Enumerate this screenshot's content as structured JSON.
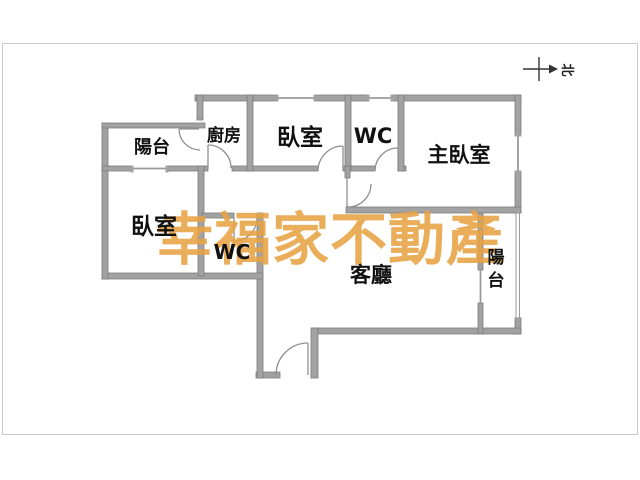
{
  "page": {
    "background": "#ffffff",
    "frame_border_color": "#cbcbcb"
  },
  "floor_plan": {
    "wall_fill": "#a2a2a2",
    "wall_edge": "#7d7d7d",
    "window_line": "#9a9a9a",
    "door_arc": "#8f8f8f",
    "rooms": {
      "balcony_left": {
        "label": "陽台"
      },
      "kitchen": {
        "label": "廚房"
      },
      "bedroom_top": {
        "label": "臥室"
      },
      "wc_top": {
        "label": "WC"
      },
      "master_bedroom": {
        "label": "主臥室"
      },
      "bedroom_left": {
        "label": "臥室"
      },
      "wc_bottom": {
        "label": "WC"
      },
      "living_room": {
        "label": "客廳"
      },
      "balcony_right": {
        "label": "陽台",
        "chars": [
          "陽",
          "台"
        ]
      }
    },
    "compass": {
      "label": "北"
    },
    "watermark": {
      "text": "幸福家不動產",
      "color": "#e8a243"
    }
  }
}
